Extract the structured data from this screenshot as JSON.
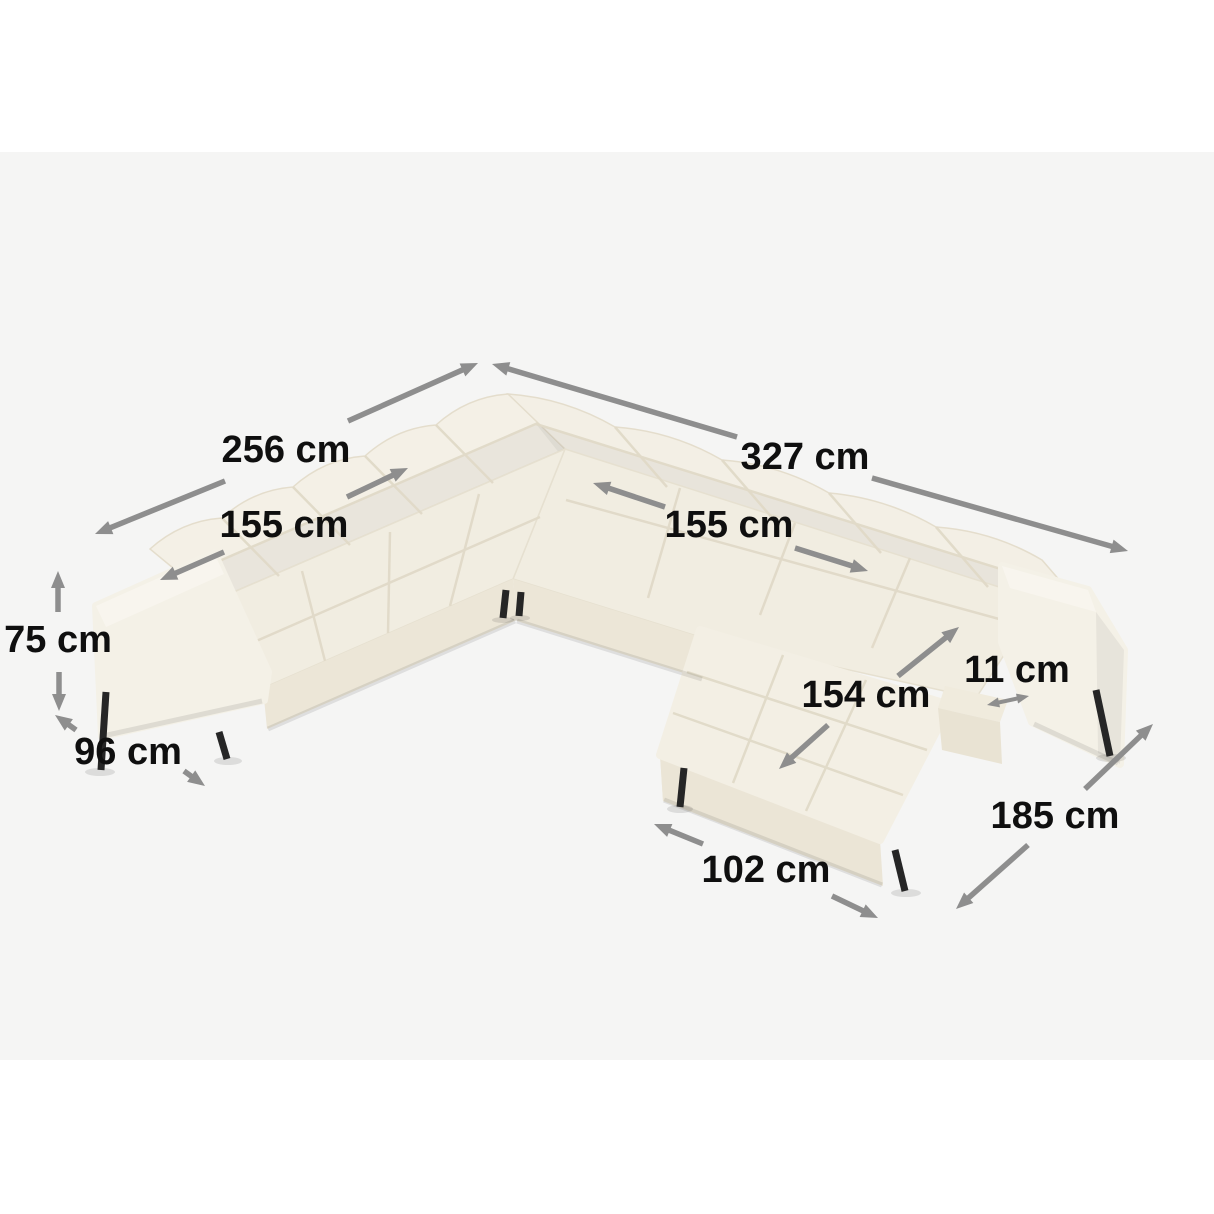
{
  "figure": {
    "type": "furniture-dimension-diagram",
    "subject": "U-shaped tufted sectional sofa with chaise, light beige fabric, black metal legs"
  },
  "colors": {
    "background": "#ffffff",
    "canvas": "#f5f5f4",
    "arrow": "#8e8e8e",
    "label_text": "#0f0f0f",
    "fabric": "#f2eee3",
    "fabric_light": "#f7f4ec",
    "fabric_shadow": "#ebe5d6",
    "legs": "#262626"
  },
  "dimensions": [
    {
      "id": "left-section-width",
      "label": "256 cm"
    },
    {
      "id": "right-section-width",
      "label": "327 cm"
    },
    {
      "id": "left-backrest-width",
      "label": "155 cm"
    },
    {
      "id": "right-backrest-width",
      "label": "155 cm"
    },
    {
      "id": "overall-height",
      "label": "75 cm"
    },
    {
      "id": "seat-depth",
      "label": "96 cm"
    },
    {
      "id": "chaise-length",
      "label": "154 cm"
    },
    {
      "id": "armrest-thickness",
      "label": "11 cm"
    },
    {
      "id": "chaise-outer-side",
      "label": "185 cm"
    },
    {
      "id": "chaise-width",
      "label": "102 cm"
    }
  ]
}
